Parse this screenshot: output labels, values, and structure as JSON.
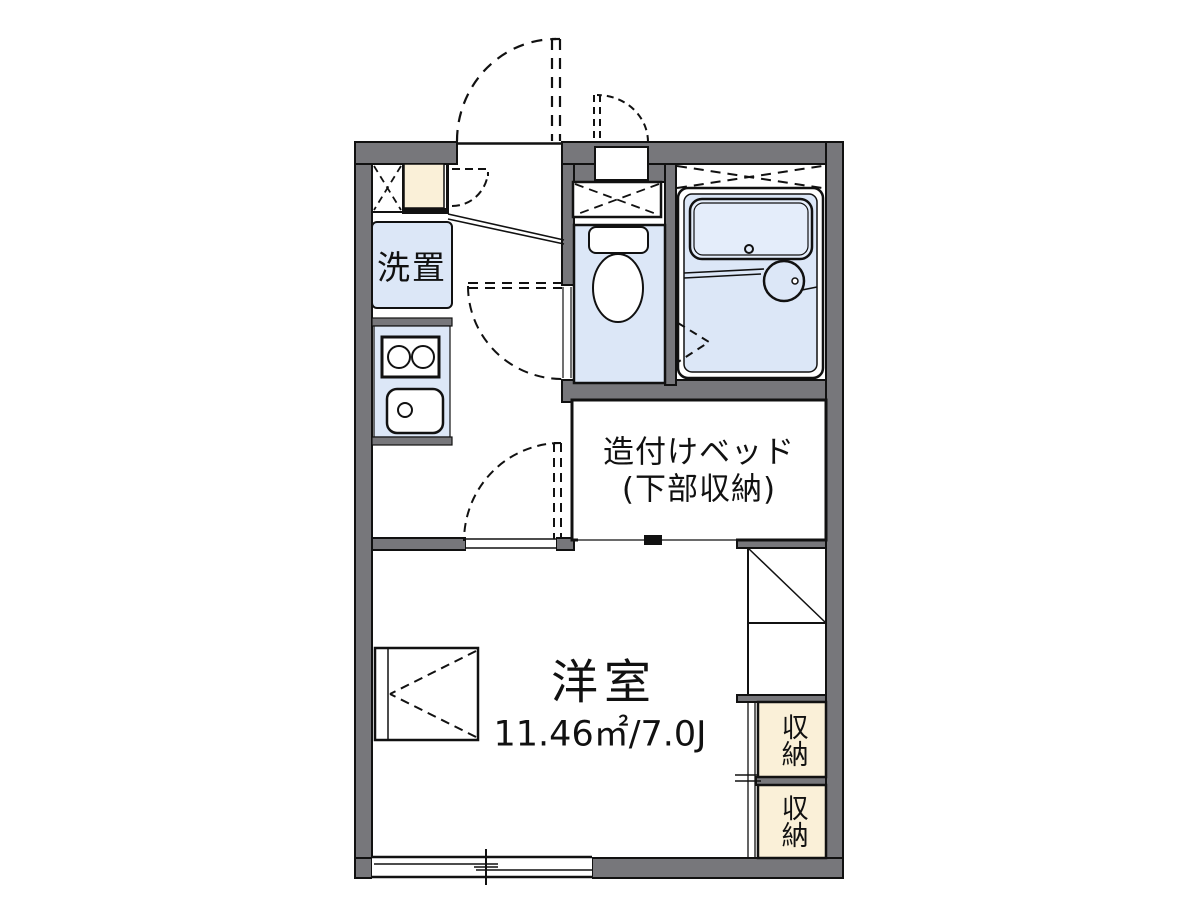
{
  "floorplan": {
    "labels": {
      "washer": "洗置",
      "bed_line1": "造付けベッド",
      "bed_line2": "(下部収納)",
      "main_room_name": "洋室",
      "main_room_size": "11.46㎡/7.0J",
      "storage_upper": "収納",
      "storage_lower": "収納"
    },
    "colors": {
      "wall": "#77777b",
      "water_fixture_fill": "#dce7f7",
      "bathtub_fill": "#e4edfa",
      "storage_fill": "#faf0d8",
      "line": "#111111",
      "background": "#ffffff"
    }
  }
}
